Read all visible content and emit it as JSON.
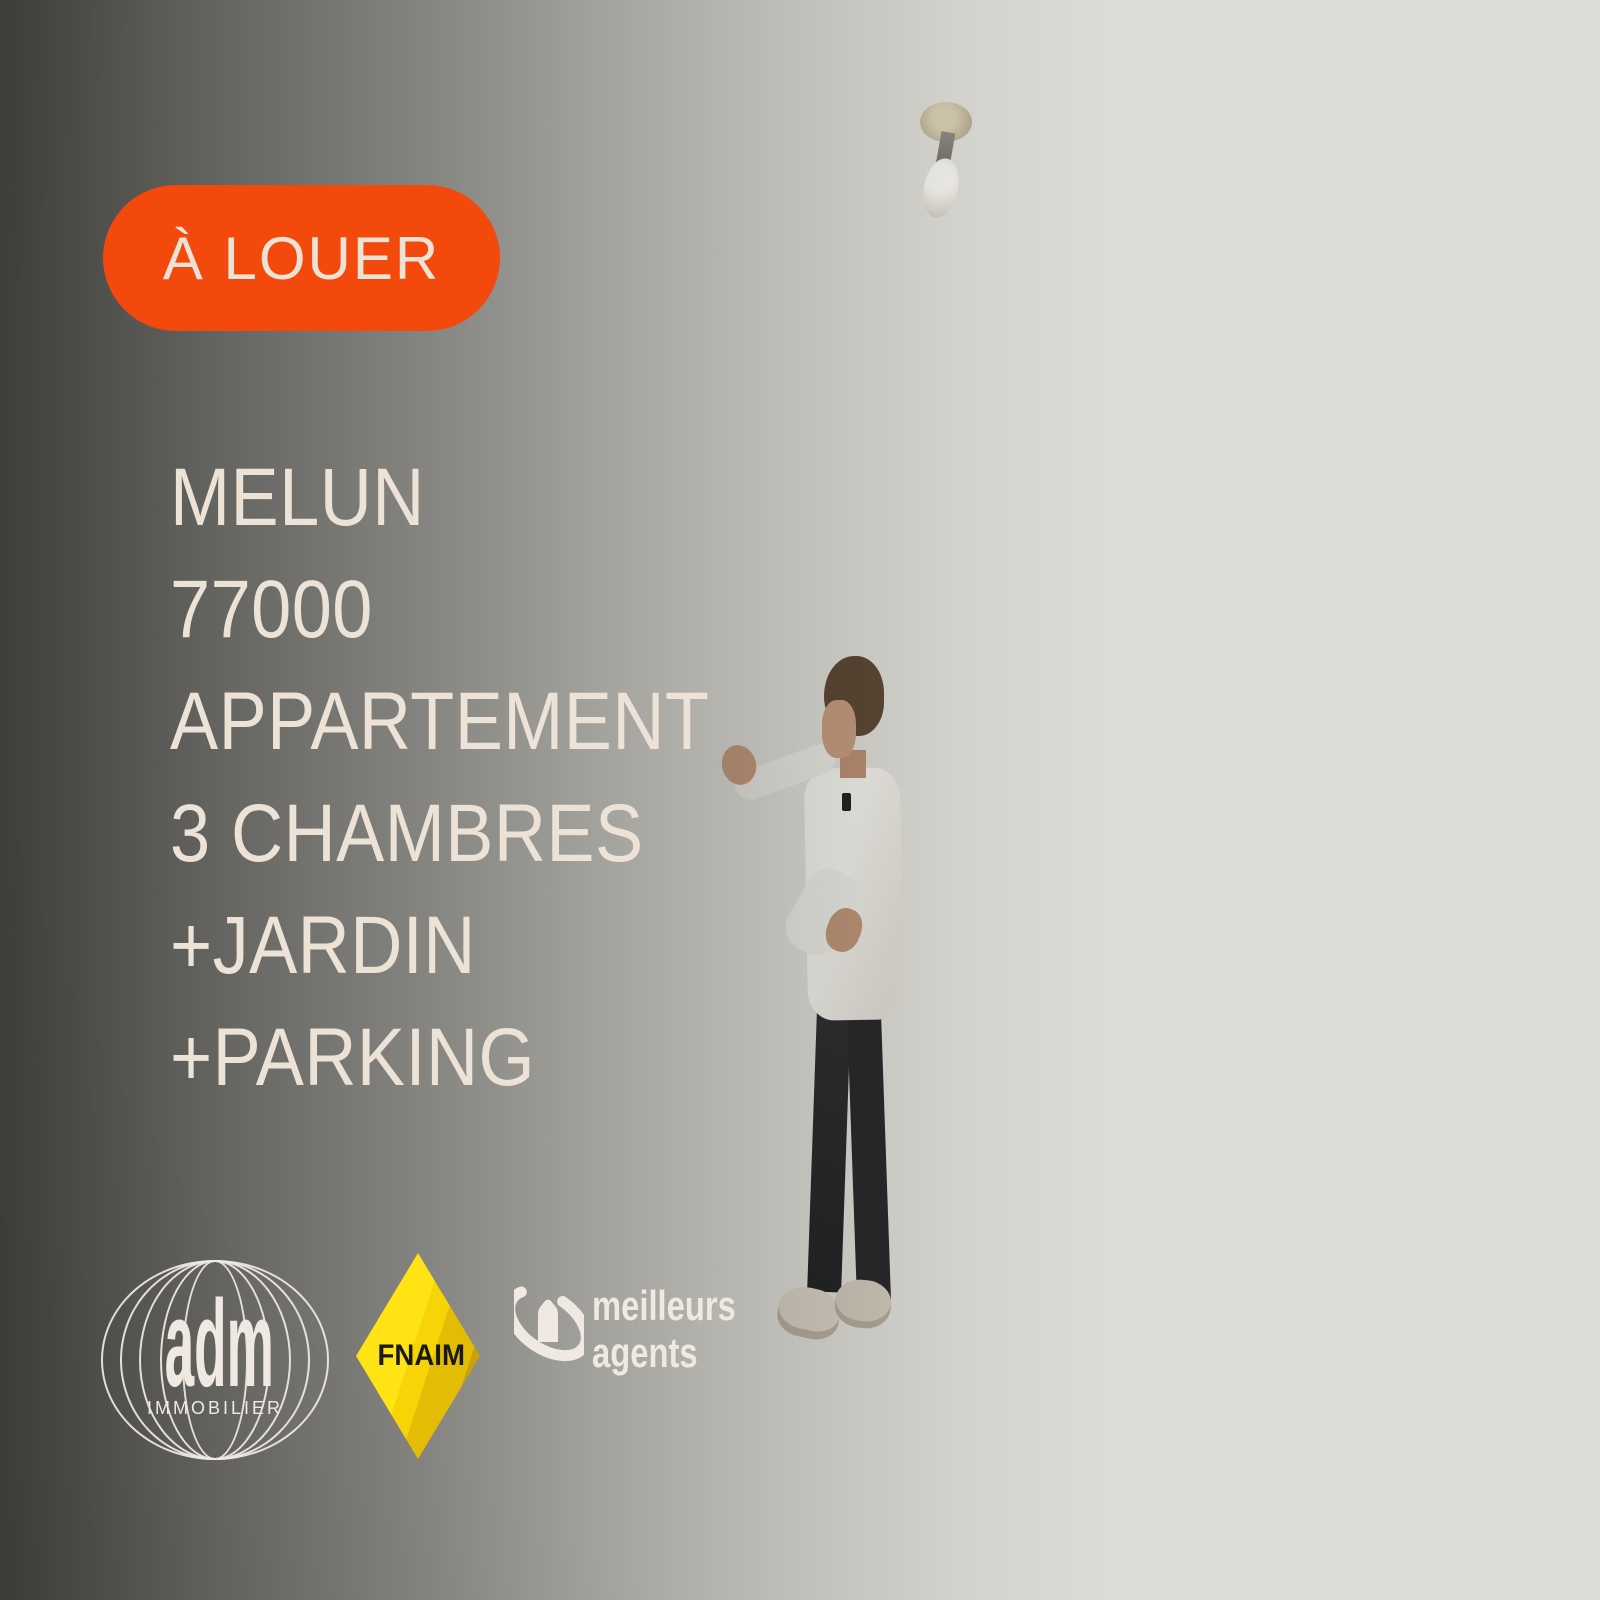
{
  "badge": {
    "label": "À LOUER"
  },
  "headline": {
    "lines": [
      "MELUN",
      "77000",
      "APPARTEMENT",
      "3 CHAMBRES",
      "+JARDIN",
      "+PARKING"
    ]
  },
  "logos": {
    "adm": {
      "wordmark": "adm",
      "subtitle": "IMMOBILIER"
    },
    "fnaim": {
      "label": "FNAIM"
    },
    "meilleurs_agents": {
      "line1": "meilleurs",
      "line2": "agents"
    }
  },
  "colors": {
    "badge_bg": "#f4490d",
    "overlay_text": "#ece2d6",
    "logo_text": "#efe9e1",
    "fnaim_yellow": "#ffe315",
    "cushion_teal": "#35a8c2"
  },
  "scene": {
    "description": "Empty apartment living room: sliding glass doors onto a garden with hedge and lawn, real-estate agent in white shirt presenting, white leather sofa with two teal cushions, radiator, white tiled floor, bare ceiling bulb"
  }
}
